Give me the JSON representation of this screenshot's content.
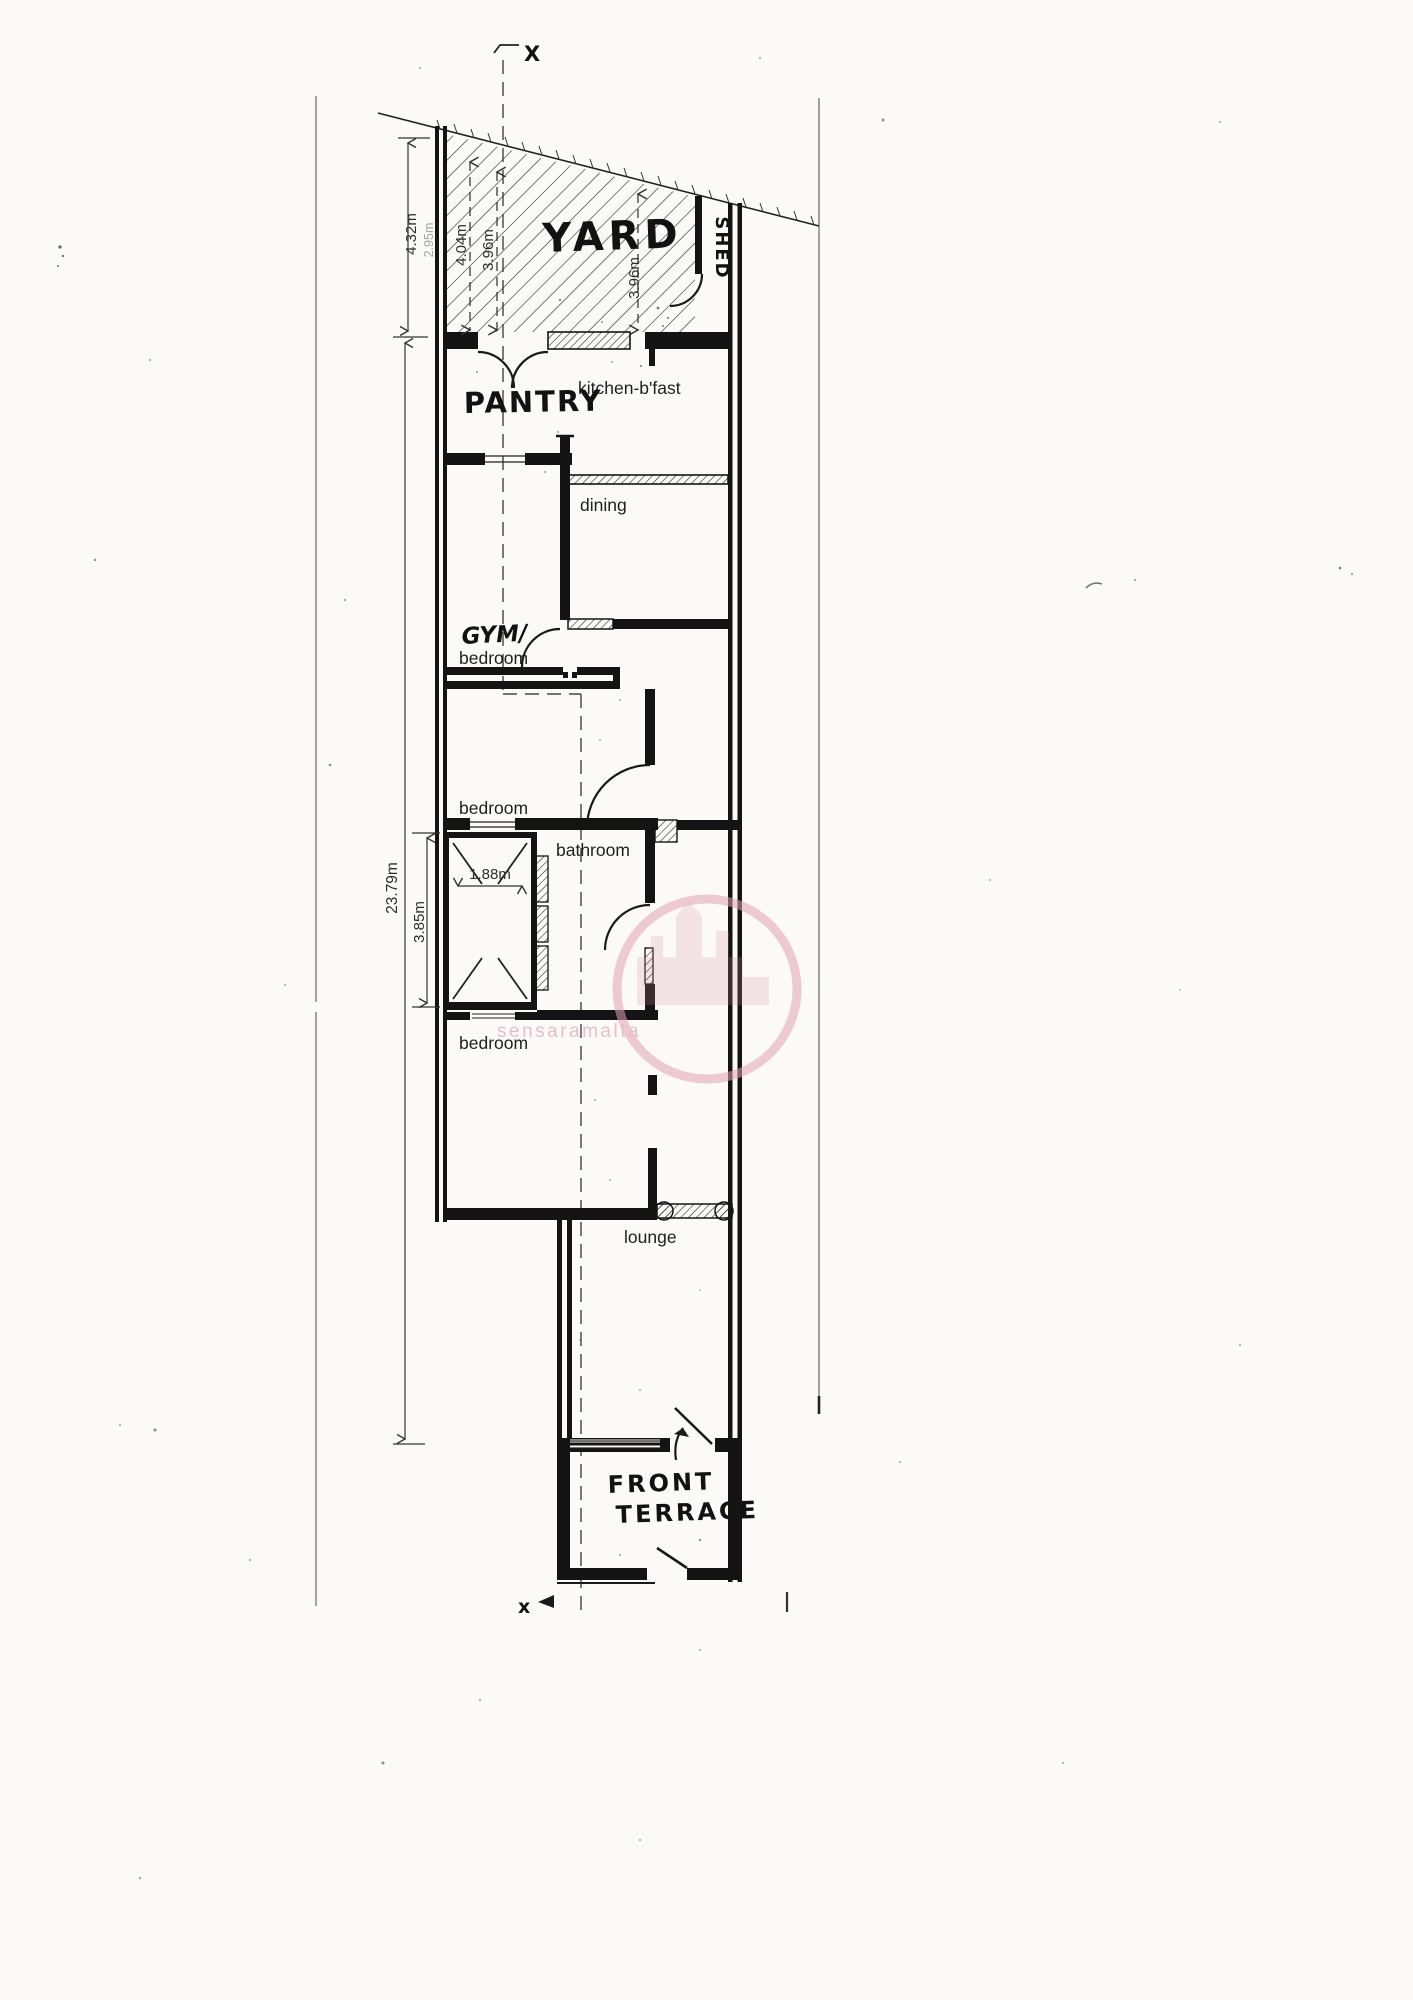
{
  "labels": {
    "section_top": "X",
    "section_bottom": "x",
    "yard": "YARD",
    "shed": "SHED",
    "pantry": "PANTRY",
    "kitchen": "kitchen-b'fast",
    "dining": "dining",
    "gym": "GYM/",
    "gym_sub": "bedroom",
    "bedroom_mid": "bedroom",
    "bathroom": "bathroom",
    "bedroom_front": "bedroom",
    "lounge": "lounge",
    "front_terrace_line1": "FRONT",
    "front_terrace_line2": "TERRACE"
  },
  "dimensions": {
    "yard_depth_left": "4.32m",
    "yard_depth_left_faint": "2.95m",
    "yard_depth_mid": "4.04m",
    "yard_depth_mid2": "3.96m",
    "yard_depth_right": "3.96m",
    "house_length": "23.79m",
    "shaft_height": "3.85m",
    "shaft_width": "1.88m"
  },
  "watermark": {
    "text": "sensaramalta",
    "color": "#d98da1"
  }
}
